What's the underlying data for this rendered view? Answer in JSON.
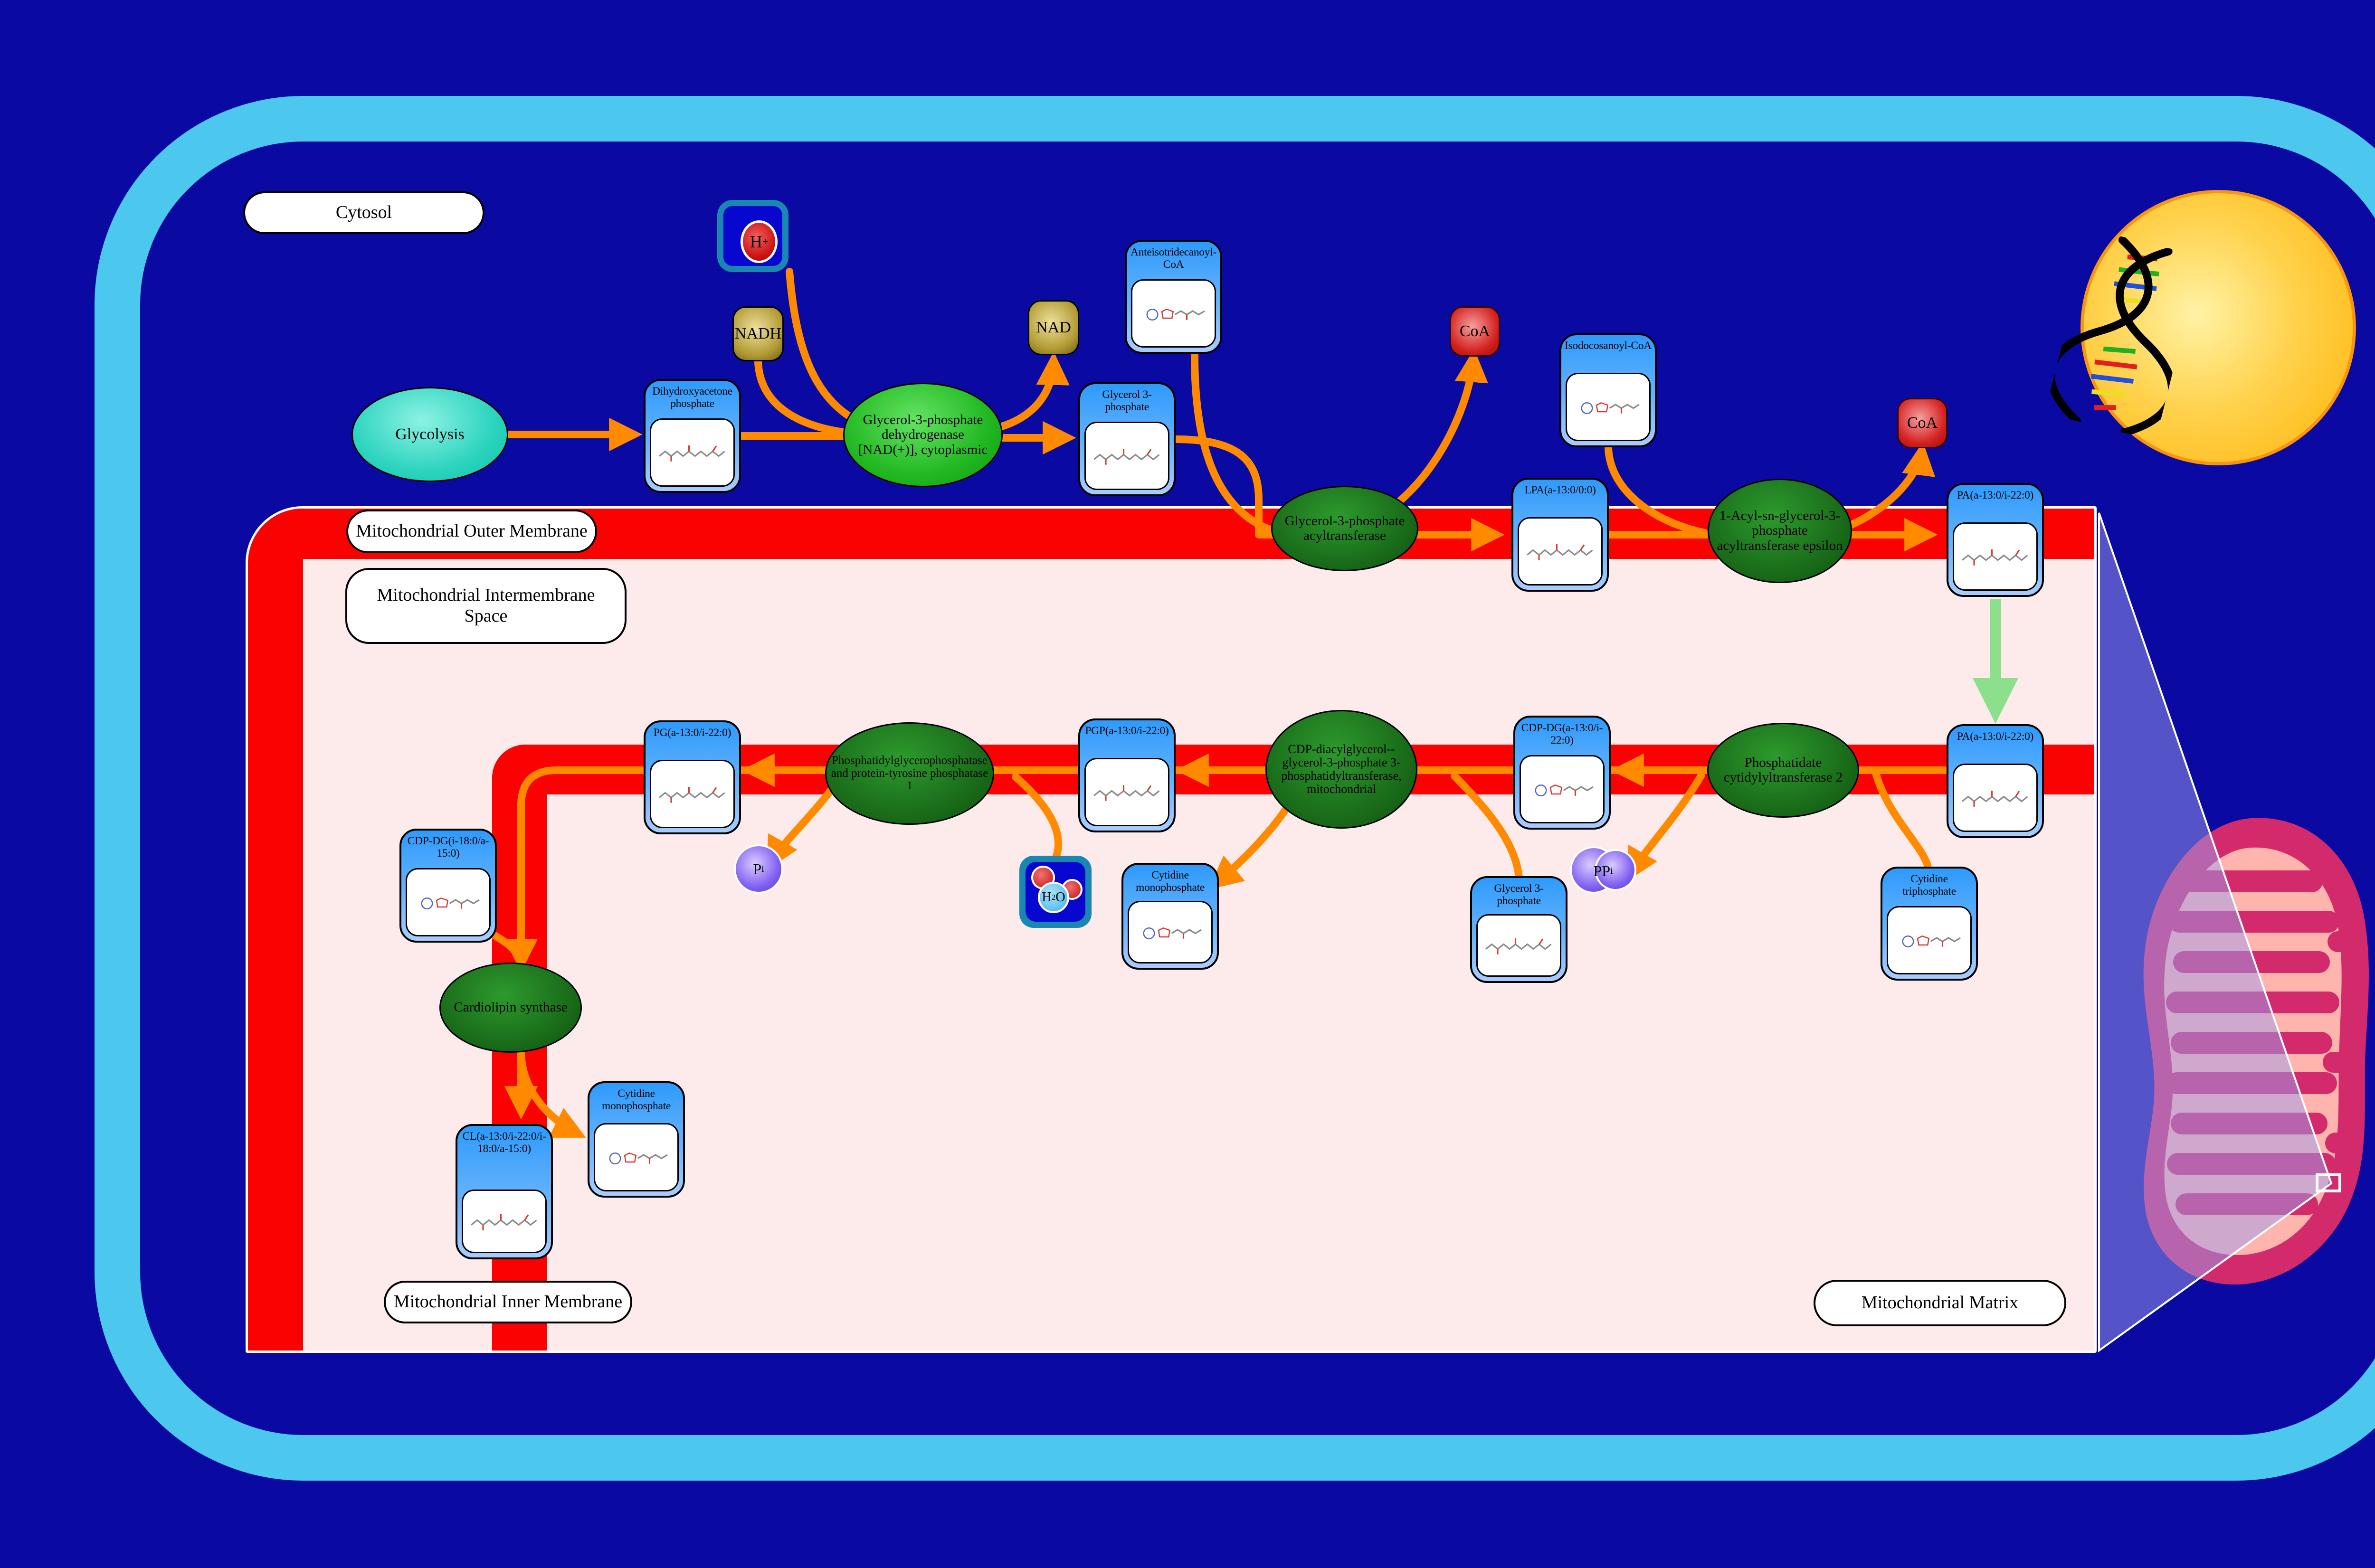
{
  "compartments": {
    "cytosol": "Cytosol",
    "outer_membrane": "Mitochondrial Outer Membrane",
    "intermembrane_space": "Mitochondrial Intermembrane Space",
    "inner_membrane": "Mitochondrial Inner Membrane",
    "matrix": "Mitochondrial Matrix"
  },
  "process": {
    "glycolysis": "Glycolysis"
  },
  "enzymes": {
    "gpd1": "Glycerol-3-phosphate dehydrogenase [NAD(+)], cytoplasmic",
    "gpat": "Glycerol-3-phosphate acyltransferase",
    "agpat_epsilon": "1-Acyl-sn-glycerol-3-phosphate acyltransferase epsilon",
    "cds2": "Phosphatidate cytidylyltransferase 2",
    "pgs1": "CDP-diacylglycerol--glycerol-3-phosphate 3-phosphatidyltransferase, mitochondrial",
    "ptpmt1": "Phosphatidylglycerophosphatase and protein-tyrosine phosphatase 1",
    "cls": "Cardiolipin synthase"
  },
  "metabolites": {
    "dhap": "Dihydroxyacetone phosphate",
    "g3p": "Glycerol 3-phosphate",
    "anteiso_coa": "Anteisotridecanoyl-CoA",
    "isodoco_coa": "Isodocosanoyl-CoA",
    "lpa": "LPA(a-13:0/0:0)",
    "pa": "PA(a-13:0/i-22:0)",
    "cdp_dg_a": "CDP-DG(a-13:0/i-22:0)",
    "ctp": "Cytidine triphosphate",
    "pgp": "PGP(a-13:0/i-22:0)",
    "cmp": "Cytidine monophosphate",
    "pg": "PG(a-13:0/i-22:0)",
    "cdp_dg_i": "CDP-DG(i-18:0/a-15:0)",
    "cl": "CL(a-13:0/i-22:0/i-18:0/a-15:0)"
  },
  "cofactors": {
    "nadh": "NADH",
    "nad": "NAD",
    "coa": "CoA",
    "h_symbol": "H",
    "h_charge": "+",
    "h2o_h": "H",
    "h2o_sub": "2",
    "h2o_o": "O",
    "pi_main": "P",
    "pi_sub": "i",
    "ppi_main": "PP",
    "ppi_sub": "i"
  },
  "colors": {
    "background_navy": "#0a0aa2",
    "cell_border_cyan": "#4cc7ee",
    "membrane_red": "#fa0202",
    "matrix_pink": "#fdeaea",
    "arrow_orange": "#ff8a00",
    "transport_arrow_green": "#8ce08c",
    "metabolite_blue": "#2e9afc",
    "enzyme_green": "#176617",
    "nucleus_yellow": "#ffd24d",
    "mitochondrion_crimson": "#d32a6c",
    "mitochondrion_salmon": "#ffb4ad"
  }
}
